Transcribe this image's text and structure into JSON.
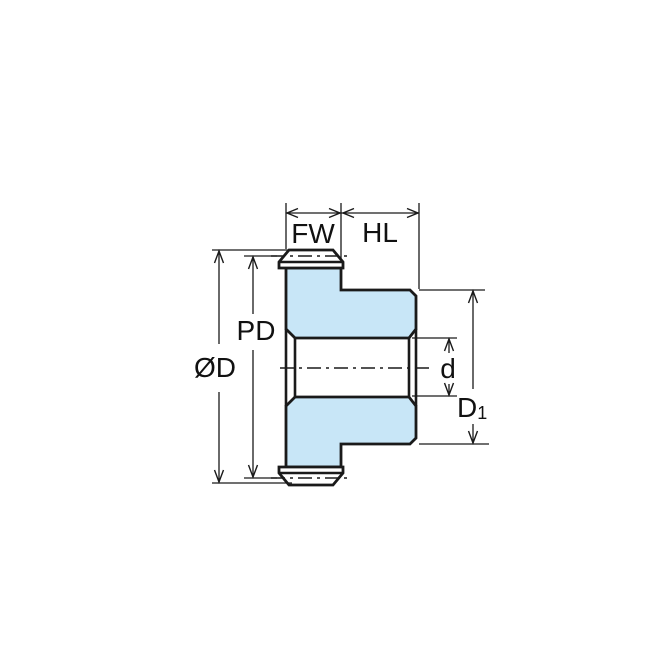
{
  "diagram": {
    "type": "gear-cross-section-dimension-drawing",
    "labels": {
      "face_width": "FW",
      "hub_length": "HL",
      "outside_diameter": "ØD",
      "pitch_diameter": "PD",
      "bore_diameter": "d",
      "hub_diameter_base": "D",
      "hub_diameter_sub": "1"
    },
    "colors": {
      "body_fill": "#c8e6f7",
      "tooth_fill": "#ffffff",
      "line": "#1a1a1a",
      "text": "#111111",
      "background": "#ffffff"
    }
  }
}
